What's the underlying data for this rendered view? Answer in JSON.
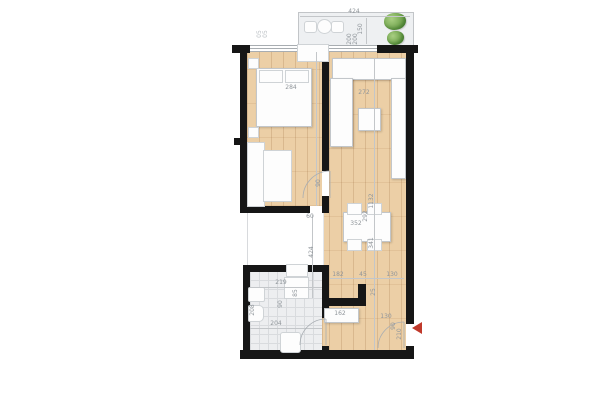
{
  "plan_title": "apartment-floor-plan",
  "colors": {
    "wall": "#161616",
    "wood_floor": "#eccfa6",
    "tile_floor": "#edeef0",
    "balcony_floor": "#eef0f2",
    "dimension_text": "#8f959a",
    "entry_arrow_red": "#c0392b",
    "plant_green": "#6fa24c"
  },
  "labels": {
    "balcony_width": "424",
    "balcony_depth": "150",
    "planter_a": "200",
    "planter_b": "200",
    "window_mark_a": "05",
    "window_mark_b": "05",
    "bed_width": "284",
    "bedroom_door": "90",
    "corridor_width": "60",
    "corridor_length": "424",
    "kitchen_width": "272",
    "living_length": "1132",
    "dining_length": "341",
    "table_depth": "292",
    "table_width": "352",
    "chain_a": "182",
    "chain_b": "45",
    "chain_c": "130",
    "chain_d": "25",
    "chain_e": "130",
    "closet_width": "162",
    "entry_door_width": "90",
    "entry_door_height": "210",
    "bath_width": "219",
    "bath_inner": "204",
    "bath_depth": "208",
    "bath_door": "90",
    "bath_fixture": "85"
  }
}
